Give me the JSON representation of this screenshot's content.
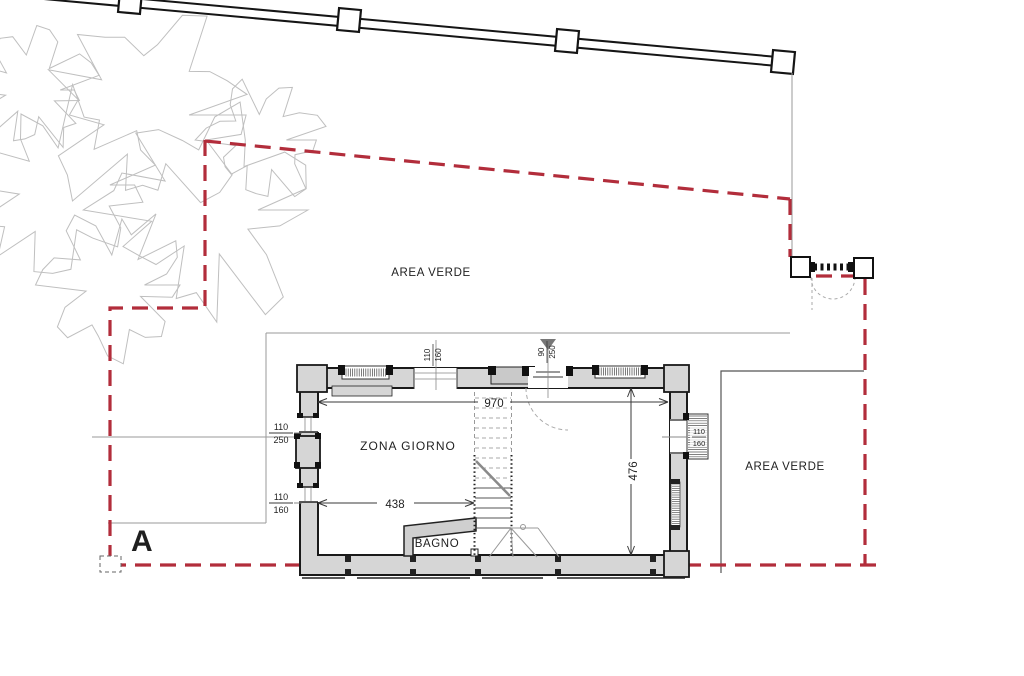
{
  "labels": {
    "area_verde_left": "AREA VERDE",
    "area_verde_right": "AREA VERDE",
    "zona_giorno": "ZONA GIORNO",
    "bagno": "BAGNO",
    "section_letter": "A"
  },
  "dimensions": {
    "interior_width": "970",
    "partial_width": "438",
    "interior_depth": "476",
    "top_window": {
      "num": "110",
      "den": "160"
    },
    "entrance_door": {
      "num": "90",
      "den": "250"
    },
    "left_window_upper": {
      "num": "110",
      "den": "250"
    },
    "left_window_lower": {
      "num": "110",
      "den": "160"
    },
    "right_window": {
      "num": "110",
      "den": "160"
    }
  },
  "colors": {
    "boundary_red": "#b22d3b",
    "wall_fill": "#d6d6d6",
    "wall_outline": "#1a1a1a",
    "sketch_gray": "#bfbfbf",
    "dim_gray": "#3a3a3a"
  }
}
